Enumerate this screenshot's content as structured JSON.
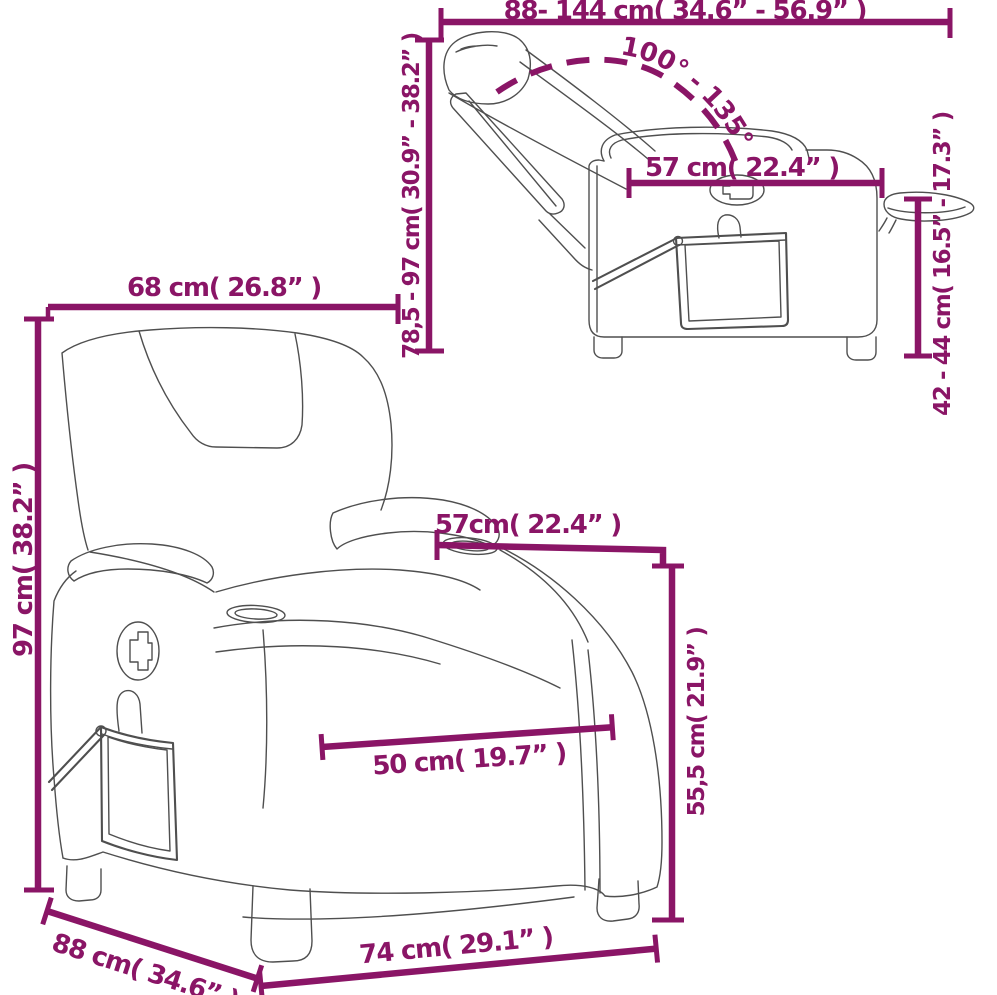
{
  "theme": {
    "accent_color": "#8a1566",
    "drawing_line_color": "#4f4f4f",
    "background_color": "#ffffff"
  },
  "diagram": {
    "product": "recliner-chair-dimension-drawing",
    "side_view": {
      "width_range_label": "88- 144 cm( 34.6” - 56.9” )",
      "recline_angle_label": "100° - 135°",
      "back_width_label": "57 cm( 22.4” )",
      "height_range_label": "78,5 - 97 cm( 30.9” - 38.2” )",
      "table_height_range_label": "42 - 44 cm( 16.5” - 17.3” )"
    },
    "front_view": {
      "overall_width_label": "68 cm( 26.8” )",
      "overall_height_label": "97 cm( 38.2” )",
      "back_width_label": "57cm( 22.4” )",
      "arm_height_label": "55,5 cm( 21.9” )",
      "seat_width_label": "50 cm( 19.7” )",
      "depth_label": "88 cm( 34.6” )",
      "base_width_label": "74 cm( 29.1” )"
    }
  }
}
